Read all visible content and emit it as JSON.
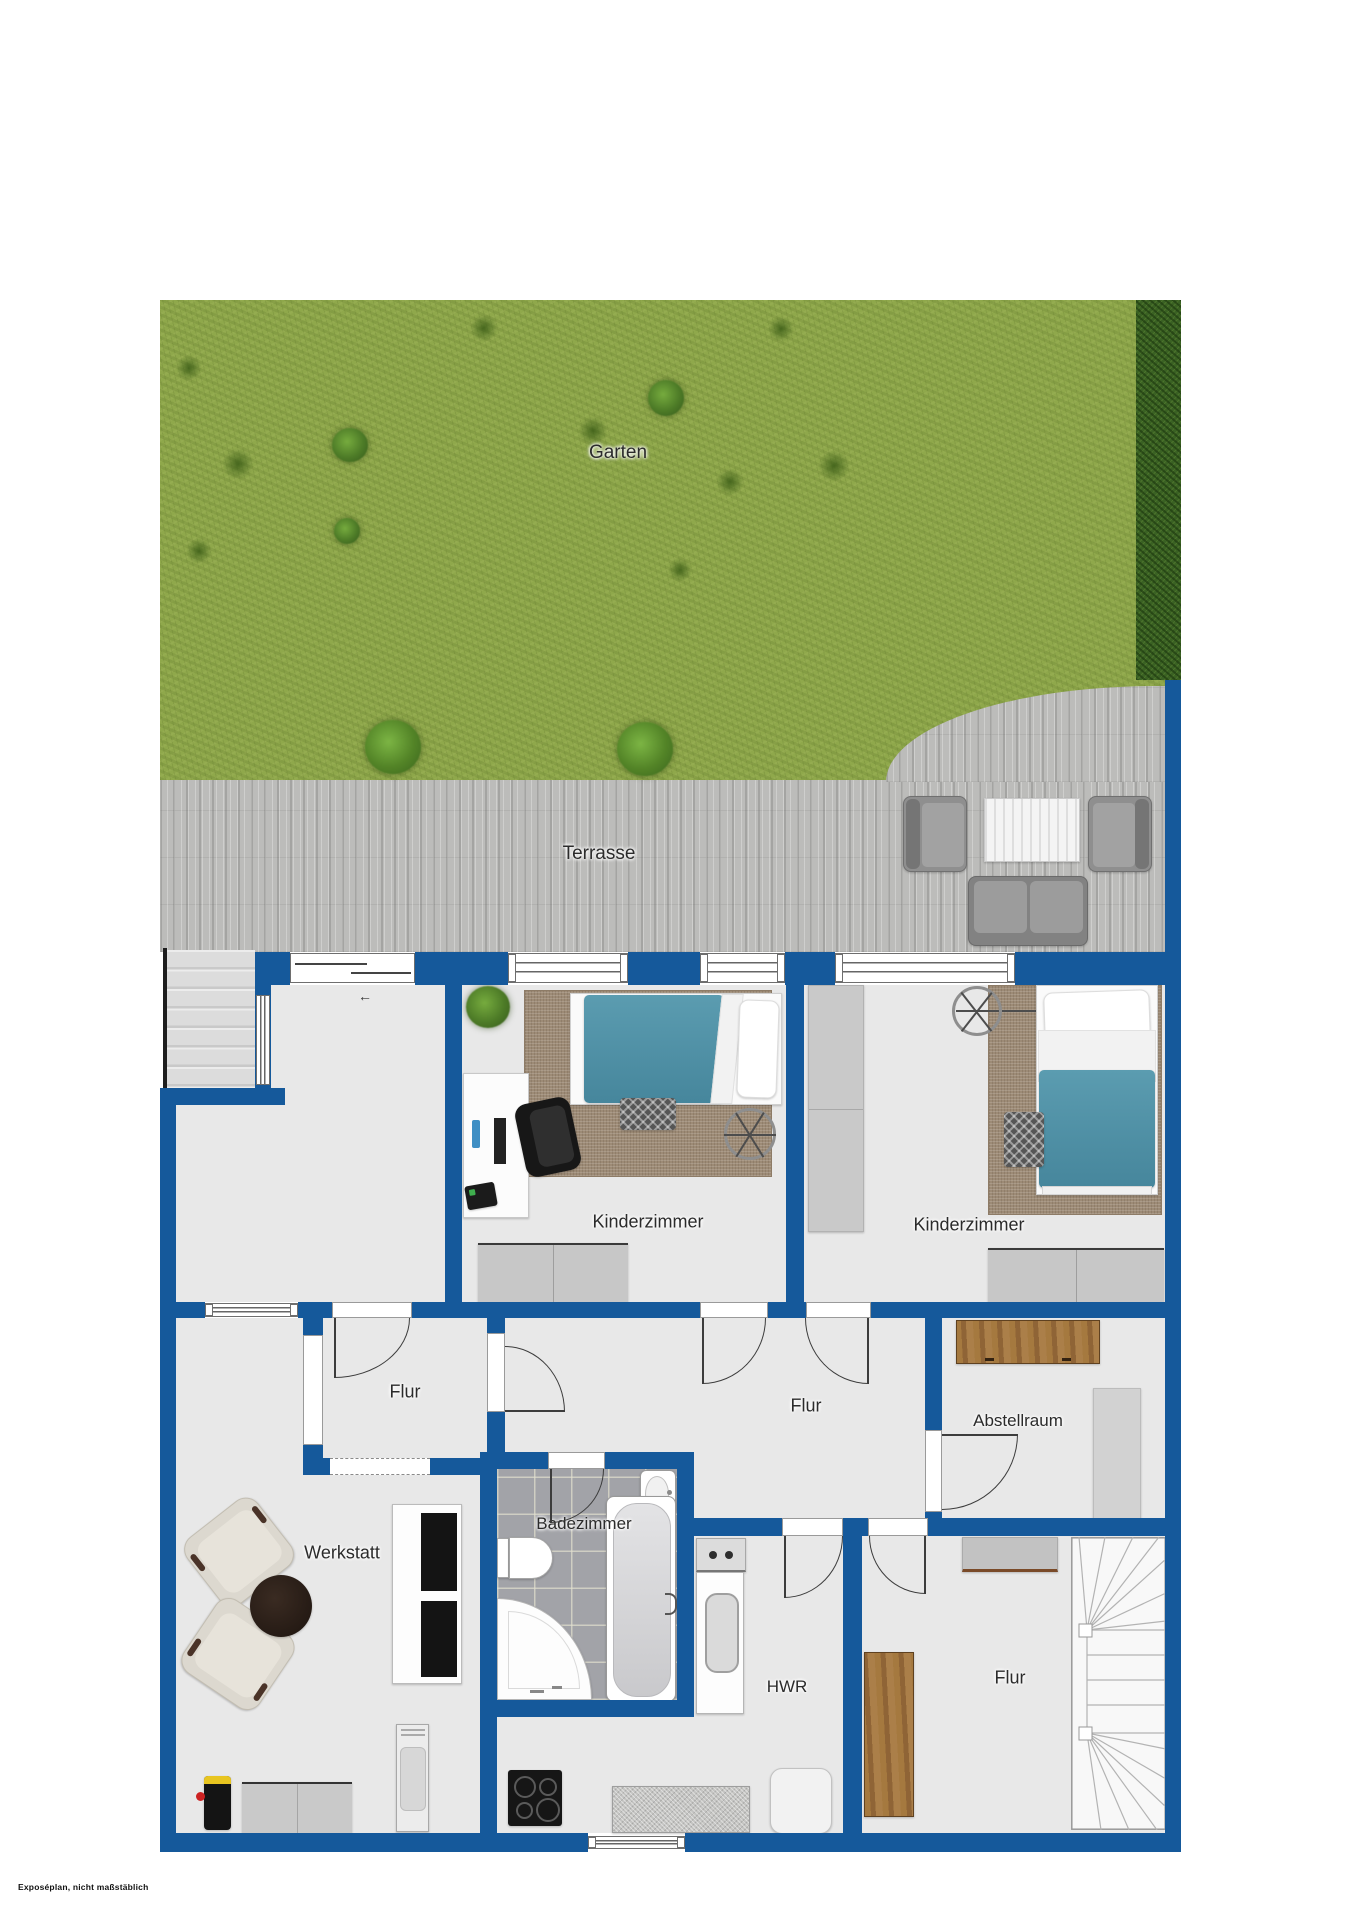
{
  "plan": {
    "type": "floorplan",
    "language": "de",
    "floor_description": "Untergeschoss mit Garten und Terrasse"
  },
  "labels": {
    "garten": "Garten",
    "terrasse": "Terrasse",
    "kinderzimmer_left": "Kinderzimmer",
    "kinderzimmer_right": "Kinderzimmer",
    "flur_small": "Flur",
    "flur_main": "Flur",
    "flur_lower": "Flur",
    "abstellraum": "Abstellraum",
    "werkstatt": "Werkstatt",
    "badezimmer": "Badezimmer",
    "hwr": "HWR"
  },
  "footer": {
    "disclaimer": "Exposéplan, nicht maßstäblich"
  },
  "colors": {
    "wall_blue": "#15599b",
    "floor_gray": "#e8e8e8",
    "grass_green": "#8fa84b",
    "hedge_green": "#3a6123",
    "terrace_gray": "#bcbcba",
    "rug_brown": "#9d8b76",
    "blanket_teal": "#4e92a9",
    "wood_brown": "#9a6b3f",
    "bath_tile": "#a2a3a8"
  },
  "icons": {
    "door_swing": "quarter-circle door arc",
    "window": "double-line window in wall",
    "sliding_door_arrow": "←",
    "ceiling_fan": "circle with spokes",
    "staircase": "winder stairs with fanned treads",
    "plant": "green bush"
  }
}
